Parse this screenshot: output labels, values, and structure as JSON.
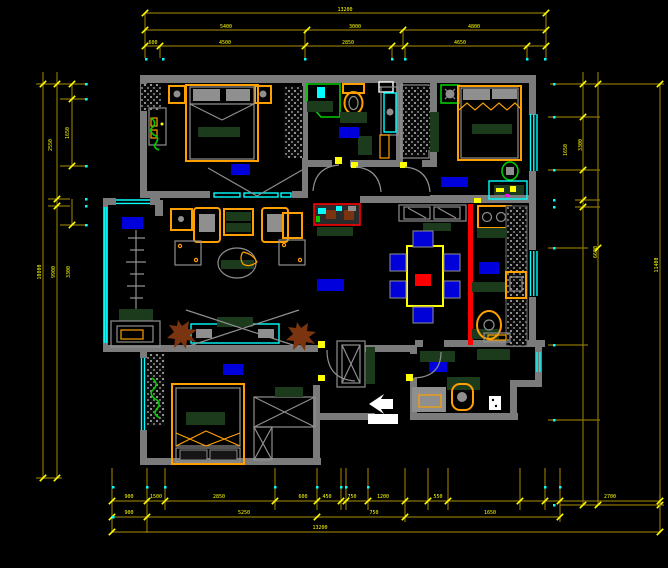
{
  "drawing": {
    "kind": "cad-floor-plan",
    "background": "#000000",
    "palette": {
      "wall": "#7b7b7b",
      "dimension_line": "#8a7300",
      "dimension_text": "#ffff00",
      "window": "#00ffff",
      "room_label_block": "#0000dd",
      "furniture_frame": "#ffa000",
      "soft_furnishing": "#1c3a1c",
      "plant": "#00cc00",
      "dry_plant": "#7b3410",
      "highlight_track": "#ff0000",
      "annotation": "#ffffff"
    },
    "icons": {
      "entry_arrow": "white-left-arrow",
      "door_swing": "quarter-arc",
      "window_symbol": "triple-cyan-line"
    },
    "room_labels": [
      "bedroom-1",
      "bathroom",
      "bedroom-2",
      "kitchen",
      "living-room",
      "balcony",
      "bedroom-3",
      "entry"
    ]
  },
  "dims": {
    "top": {
      "overall": "13200",
      "row2": [
        "5400",
        "3000",
        "4800"
      ],
      "row3": [
        "600",
        "4500",
        "2850",
        "4650"
      ]
    },
    "bottom": {
      "row1": [
        "900",
        "1500",
        "2850",
        "600",
        "450",
        "750",
        "1200",
        "550",
        "2700"
      ],
      "row2": [
        "900",
        "5250",
        "750",
        "1650"
      ],
      "overall": "13200"
    },
    "left": {
      "segments": [
        "2550",
        "1650"
      ],
      "totals": [
        "10800",
        "9900",
        "3300"
      ]
    },
    "right": {
      "segments": [
        "1650",
        "3300",
        "6600"
      ],
      "total": "11400"
    }
  }
}
